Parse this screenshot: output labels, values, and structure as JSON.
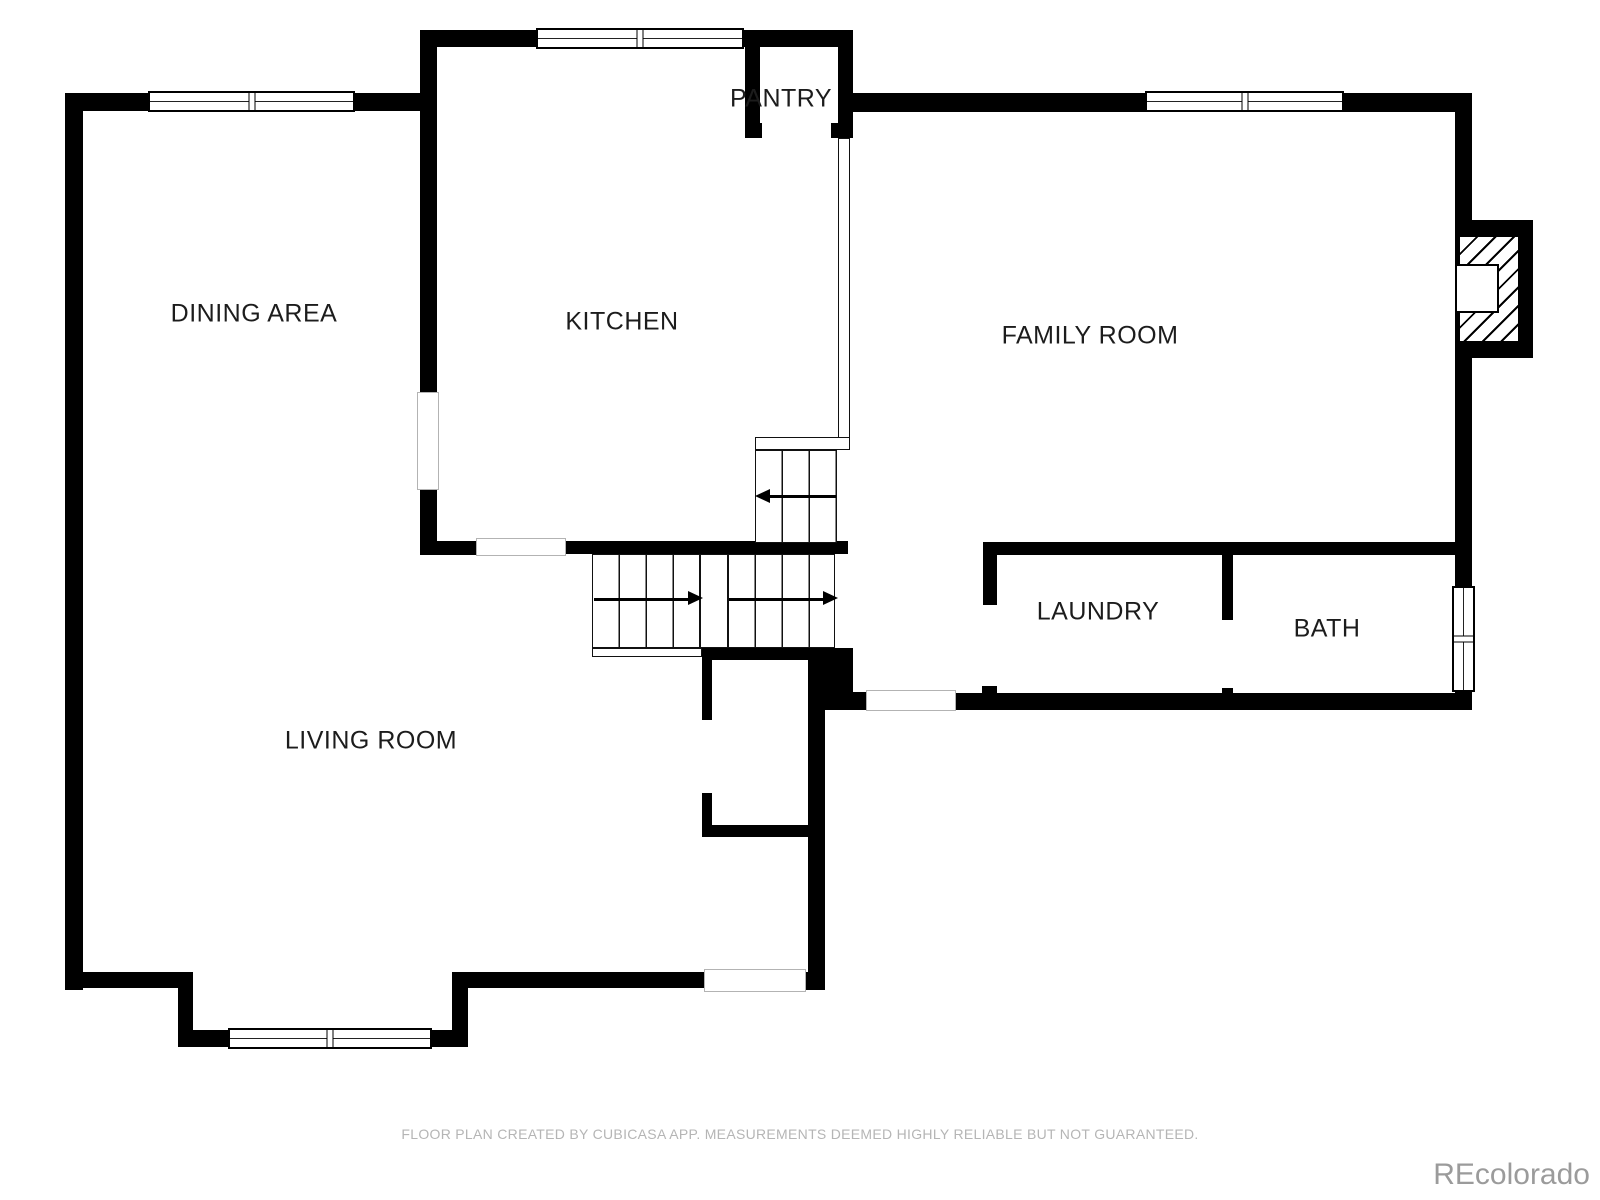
{
  "rooms": [
    {
      "name": "dining-area",
      "label": "DINING AREA"
    },
    {
      "name": "kitchen",
      "label": "KITCHEN"
    },
    {
      "name": "pantry",
      "label": "PANTRY"
    },
    {
      "name": "family-room",
      "label": "FAMILY ROOM"
    },
    {
      "name": "laundry",
      "label": "LAUNDRY"
    },
    {
      "name": "bath",
      "label": "BATH"
    },
    {
      "name": "living-room",
      "label": "LIVING ROOM"
    }
  ],
  "footer": {
    "disclaimer": "FLOOR PLAN CREATED BY CUBICASA APP. MEASUREMENTS DEEMED HIGHLY RELIABLE BUT NOT GUARANTEED."
  },
  "watermark": {
    "text": "REcolorado"
  },
  "colors": {
    "wall": "#000000",
    "label_text": "#1c1c1c",
    "footer_text": "#b5b5b5",
    "watermark_text": "#9b9b9b"
  }
}
